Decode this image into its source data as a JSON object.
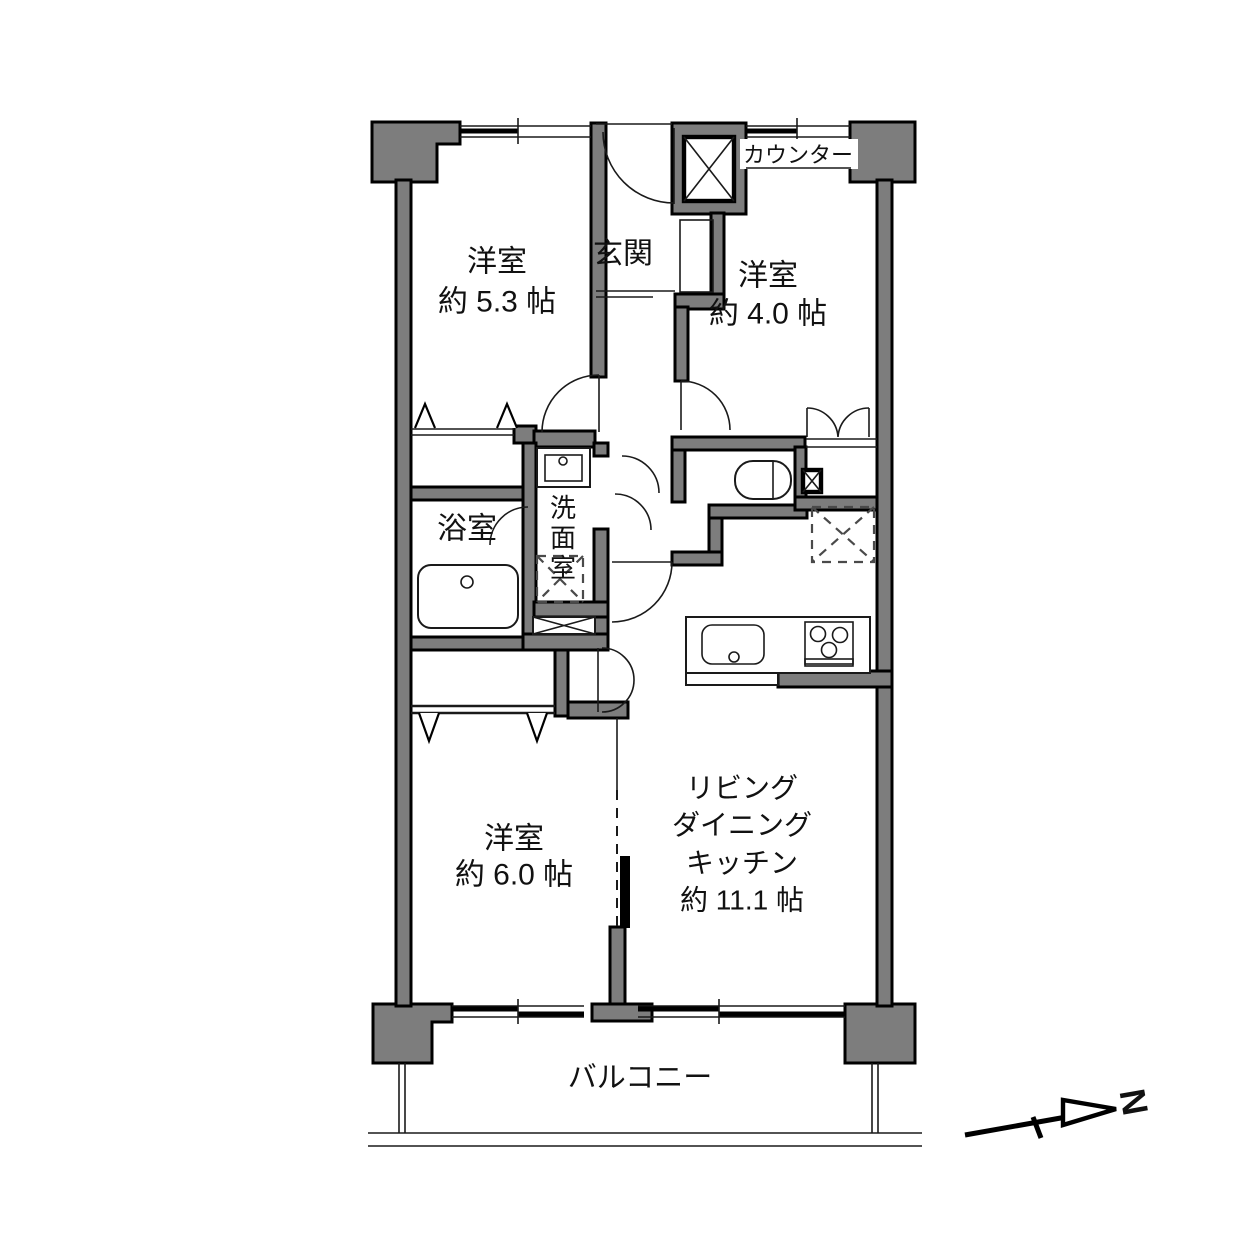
{
  "rooms": {
    "west53": {
      "name": "洋室",
      "size": "約 5.3 帖"
    },
    "west40": {
      "name": "洋室",
      "size": "約 4.0 帖"
    },
    "west60": {
      "name": "洋室",
      "size": "約 6.0 帖"
    },
    "ldk": {
      "line1": "リビング",
      "line2": "ダイニング",
      "line3": "キッチン",
      "size": "約 11.1 帖"
    },
    "entrance": {
      "name": "玄関"
    },
    "bathroom": {
      "name": "浴室"
    },
    "washroom": {
      "name": "洗面室",
      "c1": "洗",
      "c2": "面",
      "c3": "室"
    },
    "counter": {
      "name": "カウンター"
    },
    "balcony": {
      "name": "バルコニー"
    }
  },
  "compass": {
    "label": "N"
  },
  "colors": {
    "wall_fill": "#7d7d7d",
    "outline": "#000000",
    "background": "#ffffff"
  }
}
